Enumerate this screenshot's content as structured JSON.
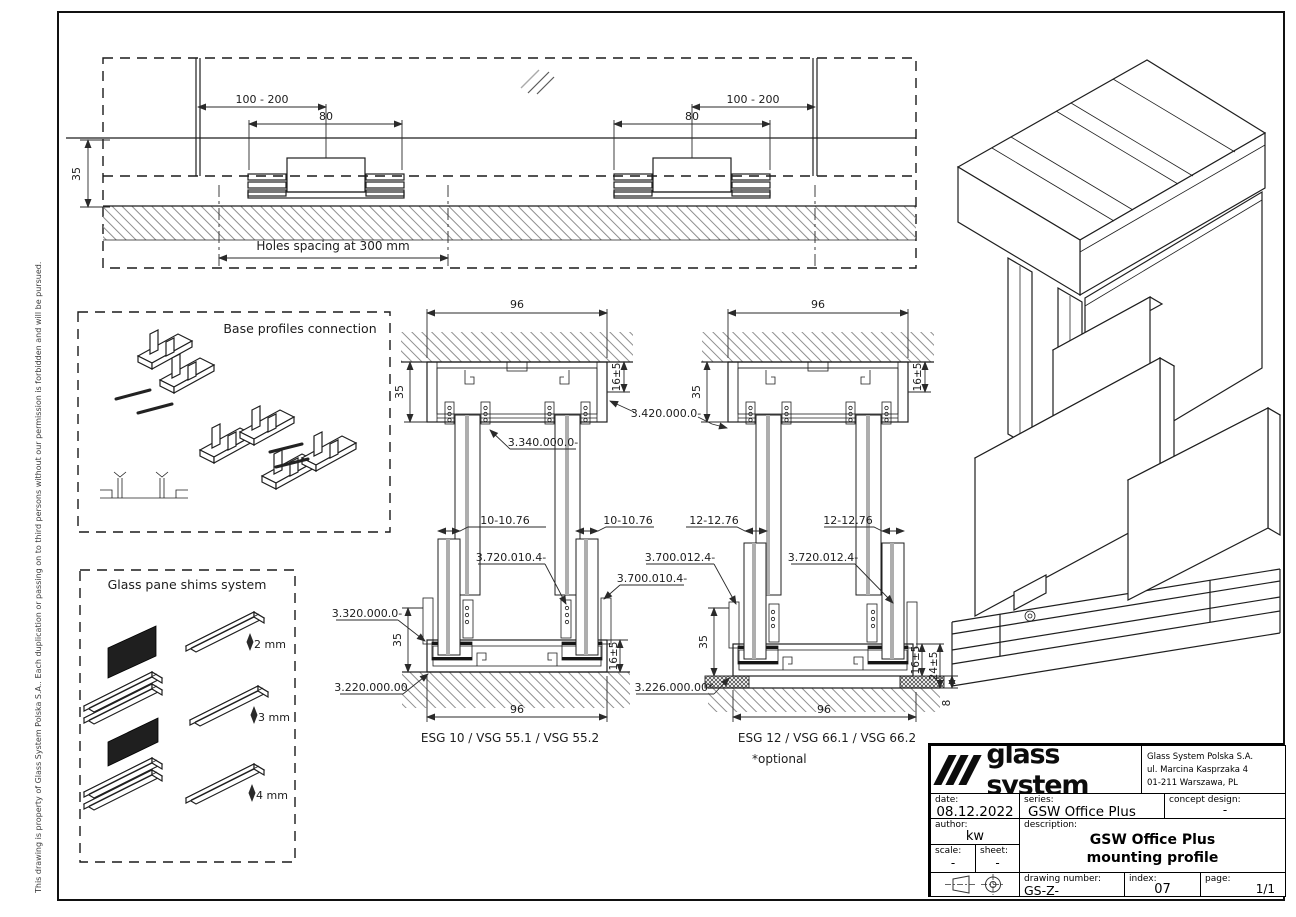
{
  "notice": "This drawing is property of Glass System Polska S.A.. Each duplication or passing on to third persons without our permission is forbidden and will be pursued.",
  "top_view": {
    "dim_range_left": "100 - 200",
    "dim_80_left": "80",
    "dim_range_right": "100 - 200",
    "dim_80_right": "80",
    "dim_wall": "35",
    "holes_note": "Holes spacing at 300 mm"
  },
  "base_profiles": {
    "title": "Base profiles connection"
  },
  "shims": {
    "title": "Glass pane shims system",
    "sizes": [
      "2 mm",
      "3 mm",
      "4 mm"
    ]
  },
  "section_ceiling_left": {
    "dim_width": "96",
    "dim_height": "35",
    "dim_depth": "16±5",
    "label_track": "3.340.000.0-"
  },
  "section_ceiling_right": {
    "dim_width": "96",
    "dim_height": "35",
    "dim_depth": "16±5",
    "label_cover": "3.420.000.0-"
  },
  "section_floor_left": {
    "dim_glass_a": "10-10.76",
    "dim_glass_b": "10-10.76",
    "label_seal": "3.720.010.4-",
    "label_gasket": "3.700.010.4-",
    "label_profile": "3.320.000.0-",
    "label_base": "3.220.000.00",
    "dim_height": "35",
    "dim_depth": "16±5",
    "dim_width": "96",
    "caption": "ESG 10 / VSG 55.1 / VSG 55.2"
  },
  "section_floor_right": {
    "dim_glass_a": "12-12.76",
    "dim_glass_b": "12-12.76",
    "label_gasket": "3.700.012.4-",
    "label_seal": "3.720.012.4-",
    "label_pad": "3.226.000.00*",
    "dim_height": "35",
    "dim_depth": "16±5",
    "dim_total": "24±5",
    "dim_pad_height": "8",
    "dim_width": "96",
    "caption": "ESG 12 / VSG 66.1 / VSG 66.2",
    "note": "*optional"
  },
  "title_block": {
    "logo_text": "glass system",
    "company": [
      "Glass System Polska S.A.",
      "ul. Marcina Kasprzaka 4",
      "01-211 Warszawa, PL"
    ],
    "date_label": "date:",
    "date": "08.12.2022",
    "series_label": "series:",
    "series": "GSW Office Plus",
    "concept_label": "concept design:",
    "concept": "-",
    "author_label": "author:",
    "author": "kw",
    "description_label": "description:",
    "description_line1": "GSW Office Plus",
    "description_line2": "mounting profile",
    "scale_label": "scale:",
    "scale": "-",
    "sheet_label": "sheet:",
    "sheet": "-",
    "drawing_number_label": "drawing number:",
    "drawing_number": "GS-Z-3.20.00.00",
    "index_label": "index:",
    "index": "07",
    "page_label": "page:",
    "page": "1/1"
  }
}
